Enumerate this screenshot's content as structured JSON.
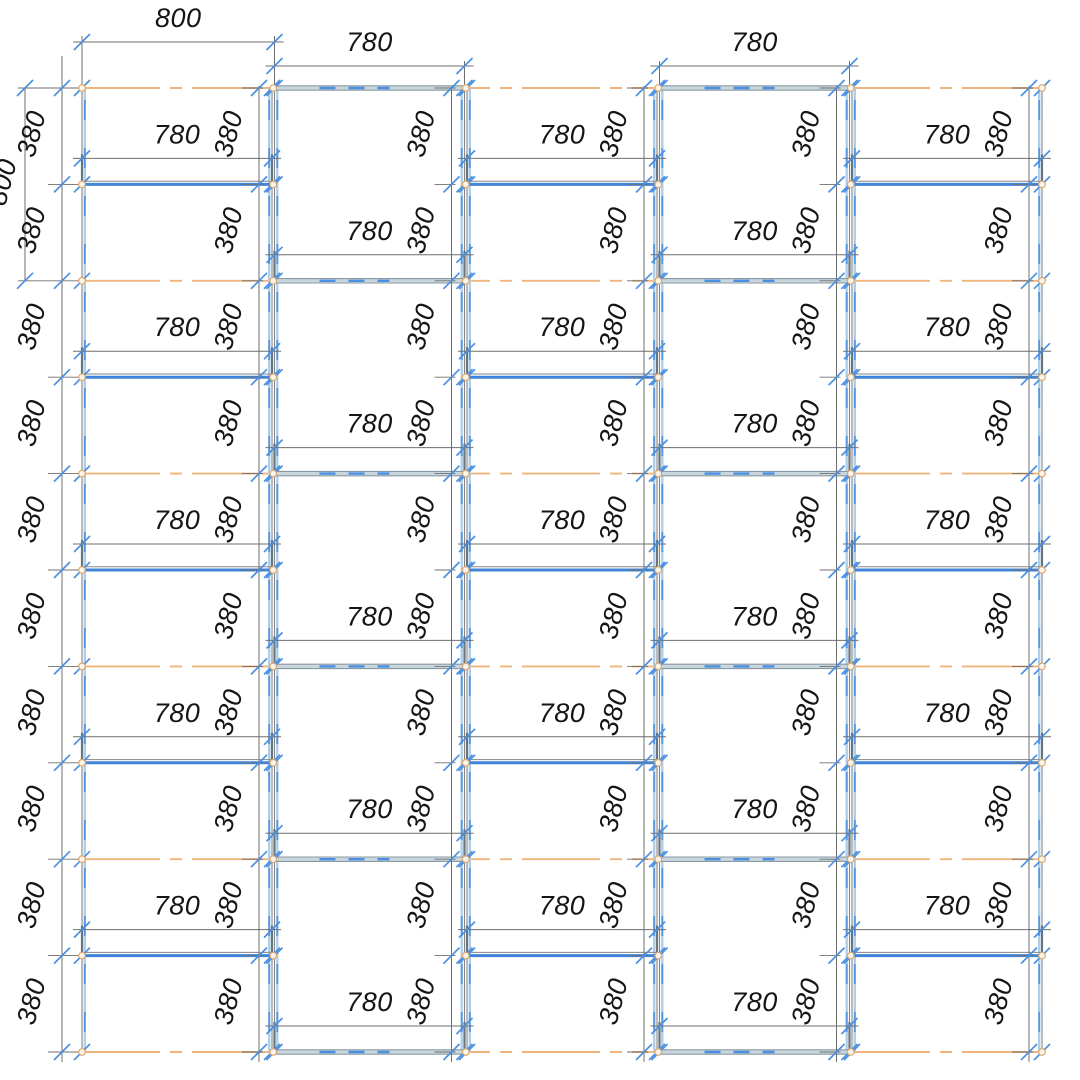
{
  "drawing": {
    "type": "panel-layout-elevation",
    "canvas": {
      "width": 1080,
      "height": 1080,
      "background": "#ffffff"
    },
    "labels": {
      "panel_width": "780",
      "row_height": "380",
      "module_width": "800",
      "module_height": "800"
    },
    "colors": {
      "axis_orange": "#EFB57C",
      "joint_blue": "#3F86DB",
      "joint_blue_dash": "#4A90E2",
      "steel_band": "#C9D6DE",
      "steel_edge": "#8A9AA4",
      "edge_gray": "#858585",
      "edge_light": "#AFCFE9",
      "edge_dash_blue": "#5598E4",
      "dim_gray": "#6F6F6F",
      "ext_stub": "#67757F",
      "tick_blue": "#4A90E2",
      "node_stroke": "#DCA96F",
      "node_fill": "#FBF4EA",
      "text": "#151515"
    },
    "grid": {
      "column_count": 5,
      "column_left": 82,
      "column_pitch": 192.5,
      "column_width": 190,
      "level_top": 88,
      "level_pitch": 96.4,
      "level_count": 11,
      "chain_inset": 13,
      "outer_chain_x": 62,
      "left_module_dim_x": 25,
      "dim_offset_above_joint": 26,
      "top_dim_y_module": 42,
      "top_dim_y_panel": 66,
      "tick_half": 8,
      "node_radius": 3.3,
      "font_size": 27,
      "label_rotation": -75
    },
    "columns": [
      {
        "name": "column-1",
        "style": "stagger-a",
        "top_dim": "module_width",
        "has_left_chain": true,
        "has_left_module_dim": true
      },
      {
        "name": "column-2",
        "style": "stagger-b",
        "top_dim": "panel_width"
      },
      {
        "name": "column-3",
        "style": "stagger-a"
      },
      {
        "name": "column-4",
        "style": "stagger-b",
        "top_dim": "panel_width"
      },
      {
        "name": "column-5",
        "style": "stagger-a"
      }
    ]
  }
}
